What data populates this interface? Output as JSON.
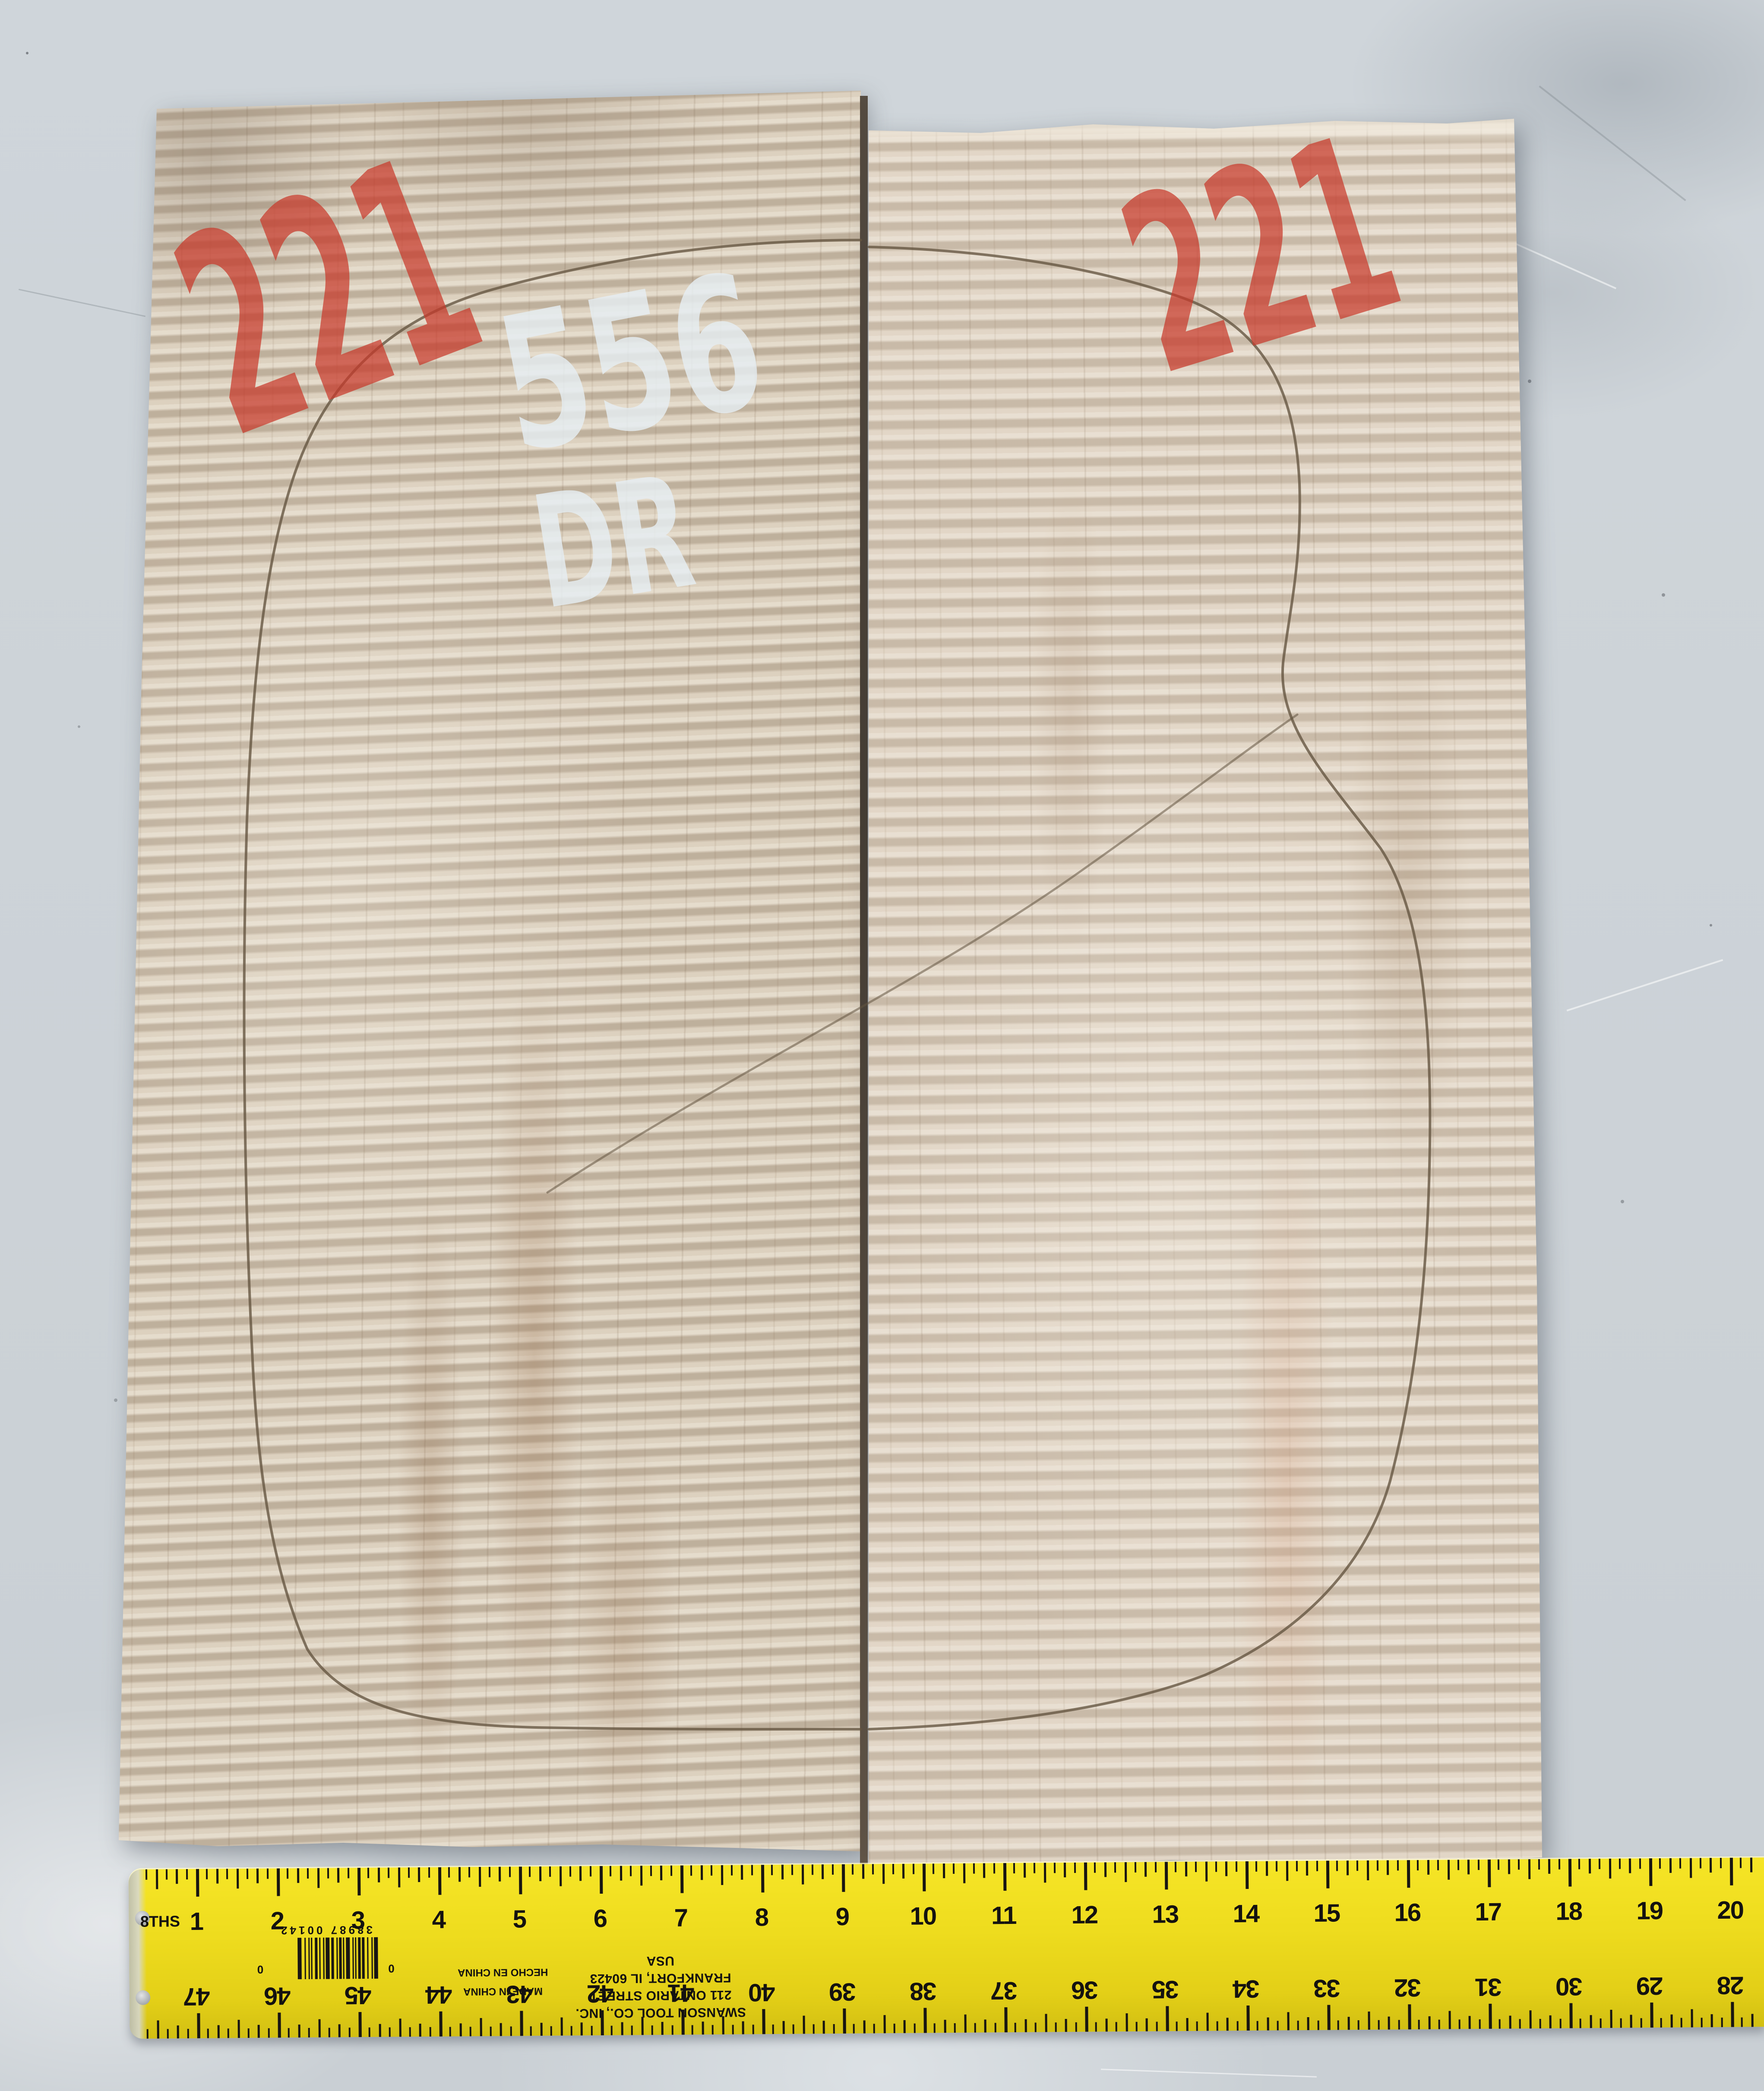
{
  "scene": {
    "description": "Two bookmatched curly maple guitar tonewood boards on a light gray table, pencil guitar-body outline drawn across both, handwritten lot markings, yellow ruler along the bottom",
    "colors": {
      "floor": "#cdd3d8",
      "wood_left_base": "#cfc2af",
      "wood_right_base": "#d6c9b8",
      "seam": "#3a3127",
      "pencil": "#63533f",
      "red_marker": "#c8392b",
      "white_chalk": "#e6edf2",
      "ruler_yellow": "#eedc1e",
      "ruler_ink": "#181512"
    }
  },
  "markings": {
    "left_lot": "221",
    "right_lot": "221",
    "set_number": "556",
    "grade": "DR"
  },
  "ruler": {
    "scale_label": "8THS",
    "top_numbers": [
      "1",
      "2",
      "3",
      "4",
      "5",
      "6",
      "7",
      "8",
      "9",
      "10",
      "11",
      "12",
      "13",
      "14",
      "15",
      "16",
      "17",
      "18",
      "19",
      "20"
    ],
    "bottom_numbers": [
      "47",
      "46",
      "45",
      "44",
      "43",
      "42",
      "41",
      "40",
      "39",
      "38",
      "37",
      "36",
      "35",
      "34",
      "33",
      "32",
      "31",
      "30",
      "29",
      "28"
    ],
    "brand_line1": "SWANSON TOOL CO., INC.",
    "brand_line2": "211 ONTARIO STREET",
    "brand_line3": "FRANKFORT, IL 60423 USA",
    "origin_line1": "MADE IN CHINA",
    "origin_line2": "HECHO EN CHINA",
    "barcode_digits": "38987 00142",
    "barcode_guard_left": "0",
    "barcode_guard_right": "0"
  }
}
